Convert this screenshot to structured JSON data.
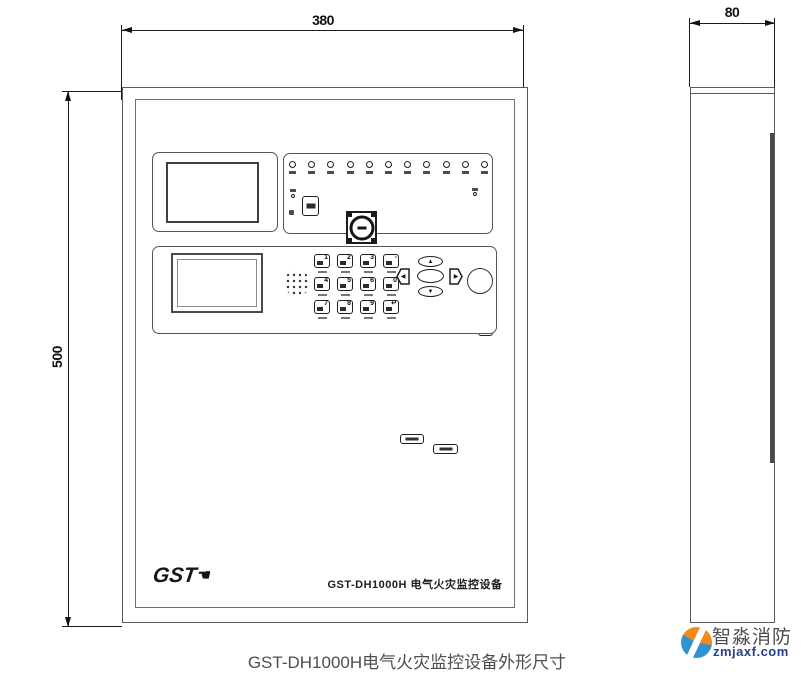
{
  "dimensions": {
    "front_width": "380",
    "front_height": "500",
    "side_depth": "80"
  },
  "front_panel": {
    "brand": "GST",
    "model_title": "GST-DH1000H 电气火灾监控设备"
  },
  "keypad": {
    "keys": [
      "1",
      "2",
      "3",
      "-",
      "4",
      "5",
      "6",
      "0",
      "7",
      "8",
      "9",
      "↵"
    ]
  },
  "nav": {
    "up": "▲",
    "down": "▼",
    "left": "◀",
    "right": "▶"
  },
  "caption": "GST-DH1000H电气火灾监控设备外形尺寸",
  "watermark": {
    "brand": "智淼消防",
    "site": "zmjaxf.com"
  }
}
